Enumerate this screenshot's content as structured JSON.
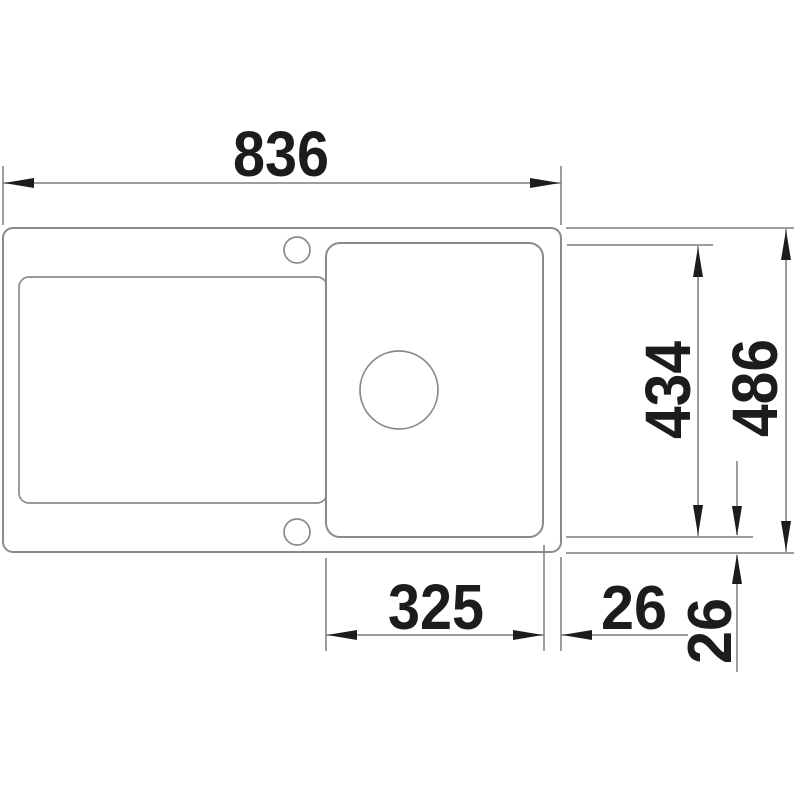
{
  "drawing": {
    "description": "Top-view technical dimension drawing of a single-bowl kitchen sink with drainboard",
    "labels": {
      "overall_width": "836",
      "bowl_height": "434",
      "overall_height": "486",
      "bowl_width": "325",
      "gap_right": "26",
      "gap_bottom": "26"
    },
    "colors": {
      "background": "#ffffff",
      "outline": "#8a8a8a",
      "dimension_marks": "#1c1c1c"
    }
  }
}
